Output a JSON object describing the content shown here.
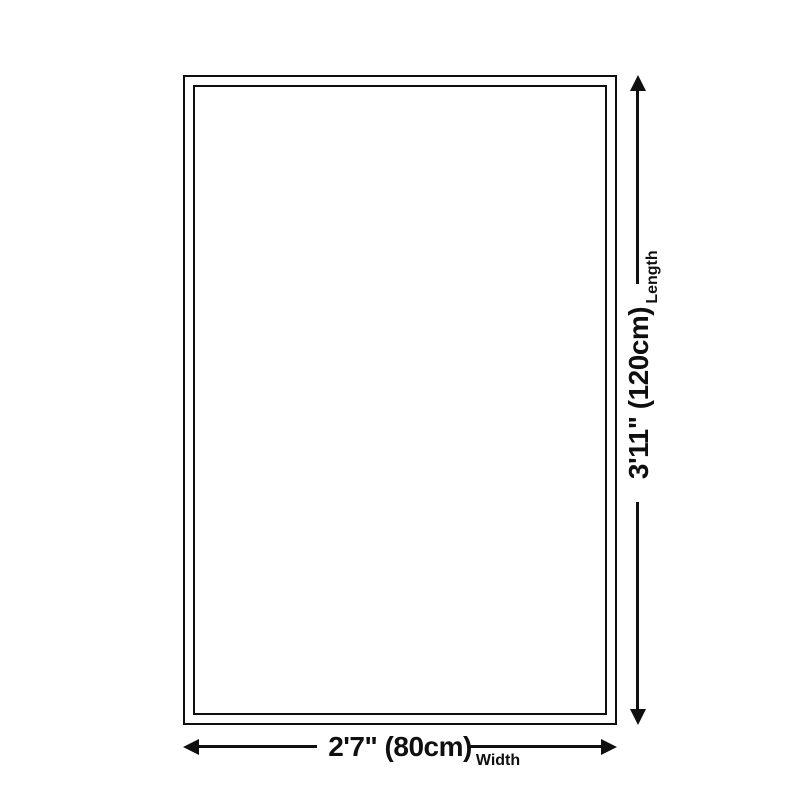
{
  "diagram": {
    "kind": "product-size-diagram",
    "dimensions": {
      "length": {
        "value": "3'11\" (120cm)",
        "label": "Length"
      },
      "width": {
        "value": "2'7\" (80cm)",
        "label": "Width"
      }
    }
  },
  "colors": {
    "ink": "#0f0f0f",
    "background": "#ffffff"
  },
  "icons": {
    "arrow_up": "triangle-up",
    "arrow_down": "triangle-down",
    "arrow_left": "triangle-left",
    "arrow_right": "triangle-right"
  }
}
